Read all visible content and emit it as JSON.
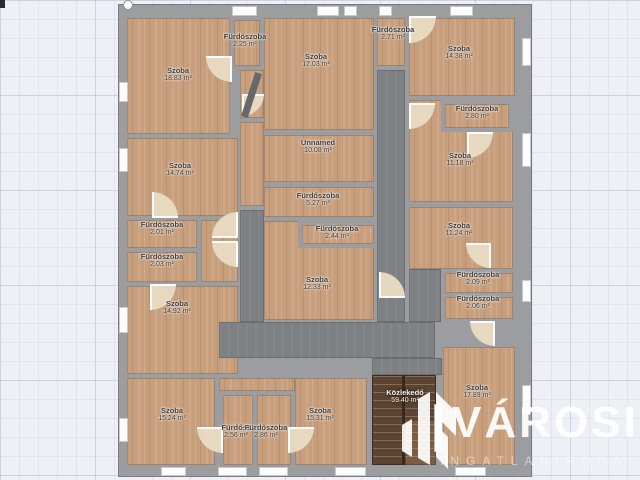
{
  "scene": {
    "type": "floorplan",
    "units": "m²",
    "colors": {
      "background": "#eef0f6",
      "grid_line": "#c8d0e2",
      "wall": "#9b9da0",
      "wood_floor": "#c89f7d",
      "corridor": "#7e8184",
      "stairs": "#5d4331",
      "door_swing": "#e9dbc2",
      "window": "#fcfcfc",
      "label_text": "#3c3c3e",
      "watermark": "#ffffff"
    }
  },
  "watermark": {
    "brand": "VÁROSI",
    "subtitle": "INGATLANIRODA",
    "logo": "bars-building-logo"
  },
  "rooms": [
    {
      "name": "Szoba",
      "area": "18.83 m²"
    },
    {
      "name": "Fürdőszoba",
      "area": "2.25 m²"
    },
    {
      "name": "Szoba",
      "area": "17.03 m²"
    },
    {
      "name": "Fürdőszoba",
      "area": "2.71 m²"
    },
    {
      "name": "Szoba",
      "area": "14.38 m²"
    },
    {
      "name": "Fürdőszoba",
      "area": "2.80 m²"
    },
    {
      "name": "Szoba",
      "area": "11.18 m²"
    },
    {
      "name": "Unnamed",
      "area": "10.08 m²"
    },
    {
      "name": "Fürdőszoba",
      "area": "5.27 m²"
    },
    {
      "name": "Szoba",
      "area": "14.74 m²"
    },
    {
      "name": "Fürdőszoba",
      "area": "2.01 m²"
    },
    {
      "name": "Fürdőszoba",
      "area": "2.03 m²"
    },
    {
      "name": "Fürdőszoba",
      "area": "2.44 m²"
    },
    {
      "name": "Szoba",
      "area": "12.33 m²"
    },
    {
      "name": "Szoba",
      "area": "11.24 m²"
    },
    {
      "name": "Fürdőszoba",
      "area": "2.09 m²"
    },
    {
      "name": "Fürdőszoba",
      "area": "2.06 m²"
    },
    {
      "name": "Szoba",
      "area": "14.92 m²"
    },
    {
      "name": "Szoba",
      "area": "15.24 m²"
    },
    {
      "name": "Fürdősz",
      "area": "2.56 m²"
    },
    {
      "name": "Fürdőszoba",
      "area": "2.86 m²"
    },
    {
      "name": "Szoba",
      "area": "15.31 m²"
    },
    {
      "name": "Közlekedő",
      "area": "59.40 m²"
    },
    {
      "name": "Szoba",
      "area": "17.89 m²"
    }
  ]
}
